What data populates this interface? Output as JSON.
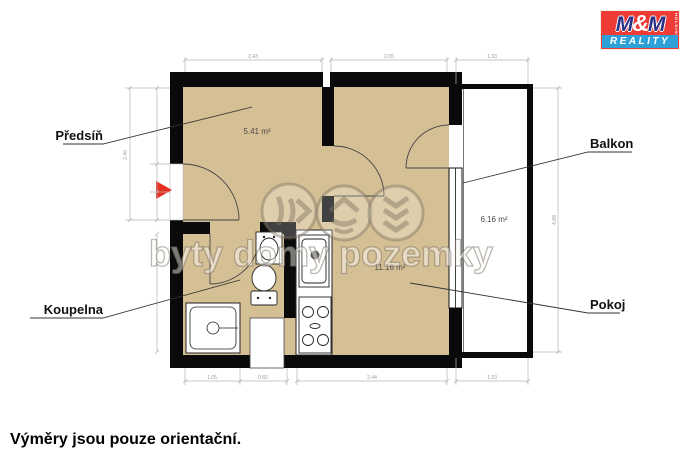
{
  "caption": "Výměry jsou pouze orientační.",
  "watermark": {
    "text": "byty domy pozemky"
  },
  "logo": {
    "m1": "M",
    "amp": "&",
    "m2": "M",
    "holding": "HOLDING",
    "reality": "REALITY"
  },
  "rooms": [
    {
      "id": "predsin",
      "label": "Předsíň",
      "area": "5.41 m²"
    },
    {
      "id": "pokoj",
      "label": "Pokoj",
      "area": "11.16 m²"
    },
    {
      "id": "koupelna",
      "label": "Koupelna",
      "area": ""
    },
    {
      "id": "balkon",
      "label": "Balkon",
      "area": "6.16 m²"
    }
  ],
  "dims": {
    "top": [
      "2.43",
      "2.05",
      "1.33"
    ],
    "bottom": [
      "1.05",
      "0.82",
      "2.44",
      "1.33"
    ],
    "left": "2.40",
    "right": "4.88"
  },
  "accent_red": "#e53022",
  "wall_color": "#0a0a0a",
  "floor_color": "#d5bf94"
}
